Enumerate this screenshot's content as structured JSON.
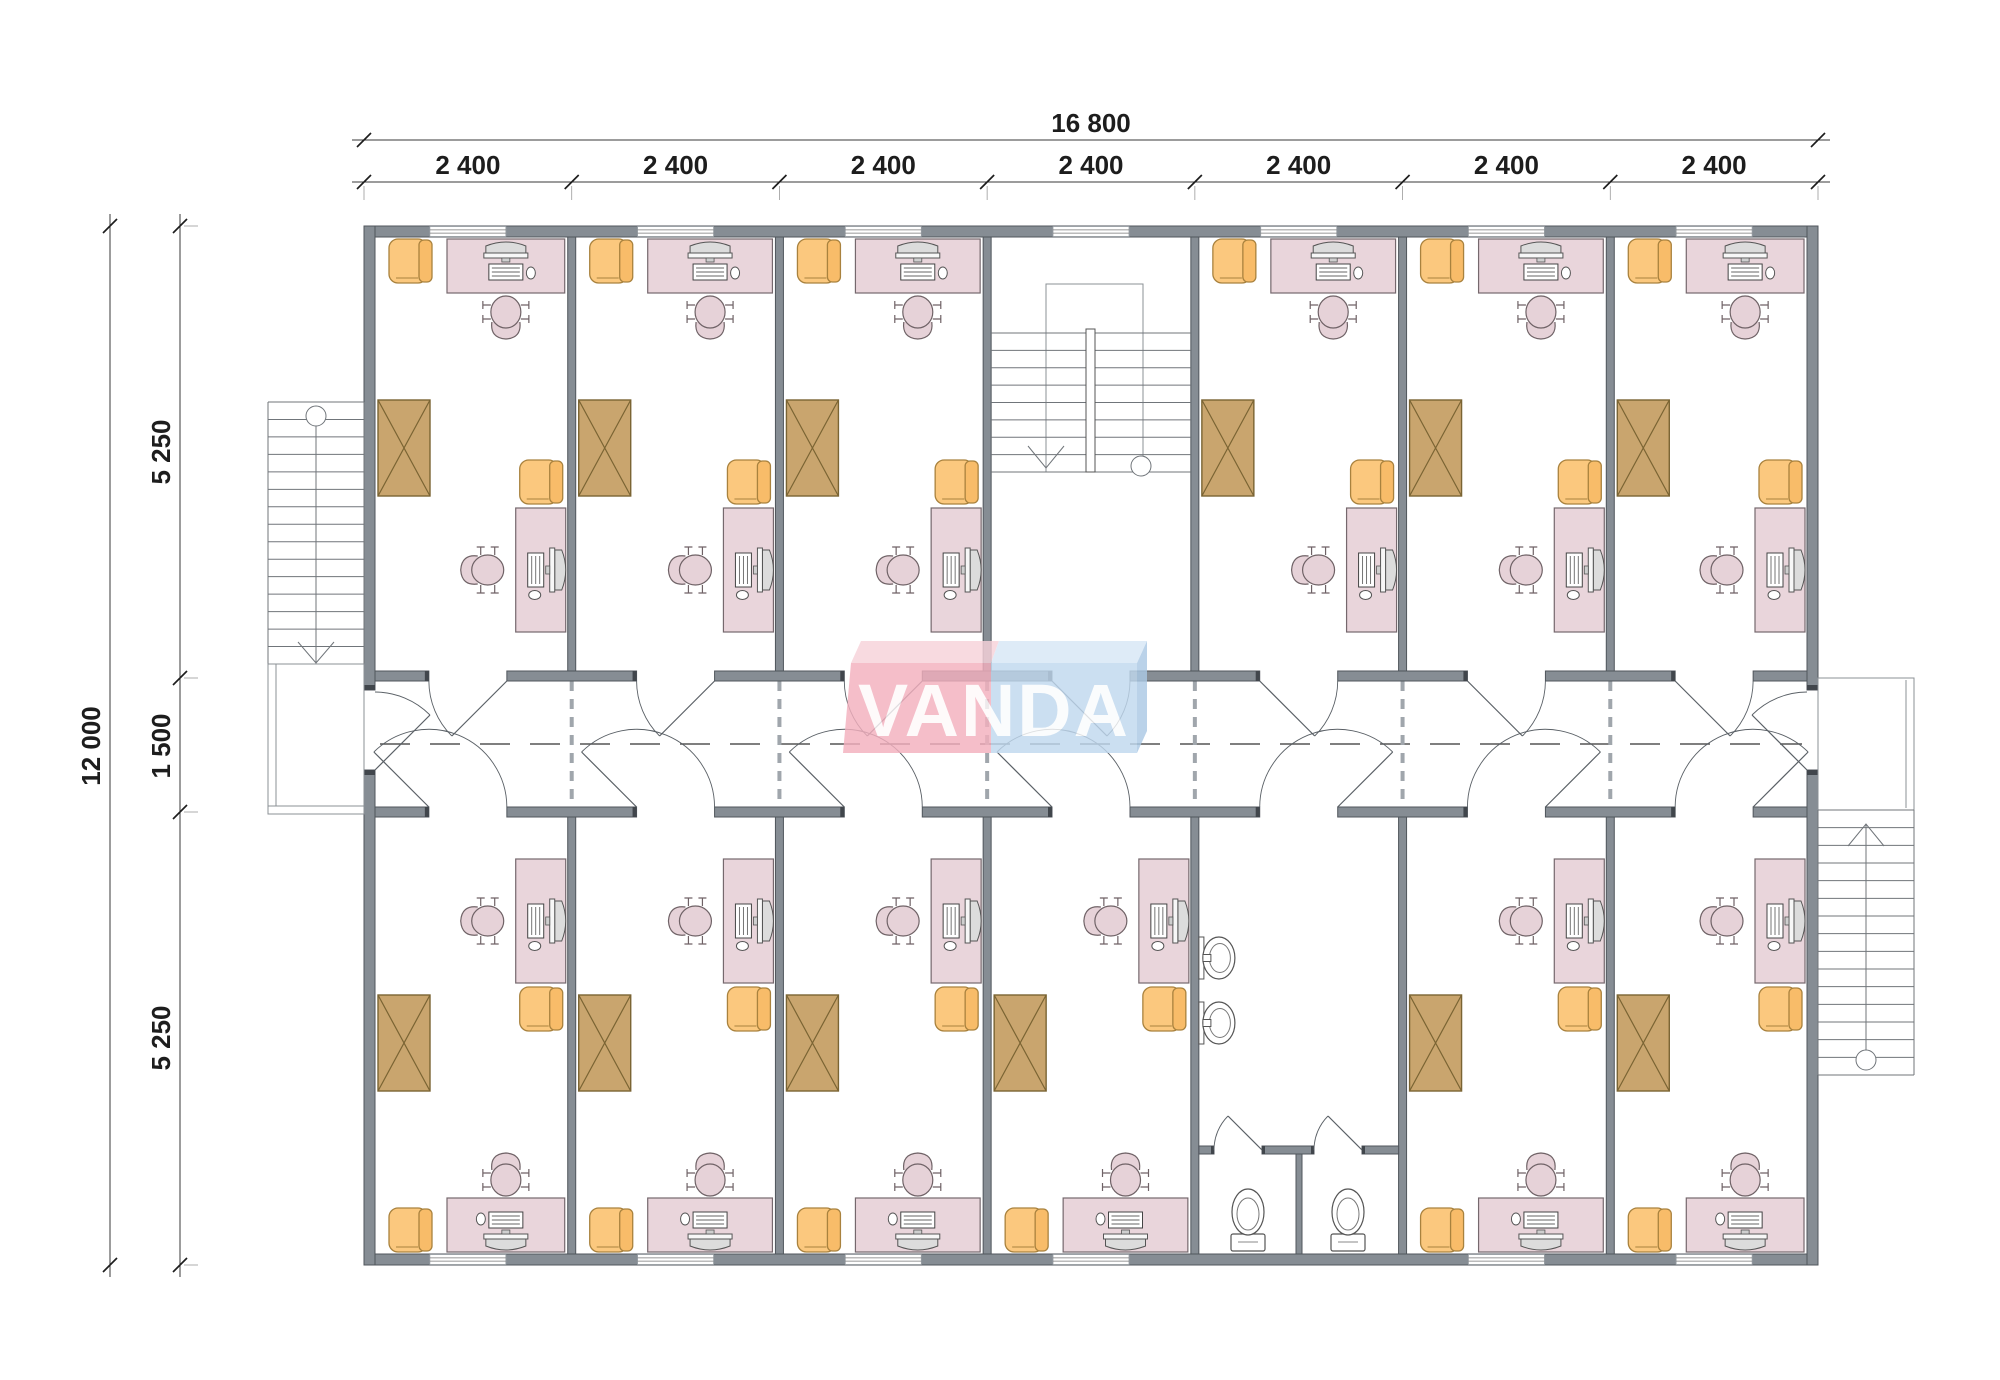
{
  "title": "VANDA modular building floor plan",
  "logo": {
    "text": "VANDA",
    "pink": "#f3b0be",
    "blue": "#c0d8ee"
  },
  "dimensions": {
    "horizontal": {
      "total": "16 800",
      "bays": [
        "2 400",
        "2 400",
        "2 400",
        "2 400",
        "2 400",
        "2 400",
        "2 400"
      ]
    },
    "vertical": {
      "total": "12 000",
      "rows": [
        "5 250",
        "1 500",
        "5 250"
      ]
    }
  },
  "colors": {
    "wall": "#868d94",
    "desk_pink": "#e9d5db",
    "chair_orange": "#fbc87e",
    "cabinet_tan": "#c9a56e",
    "dimension_text": "#1d1d1d"
  },
  "inventory": {
    "office_rooms": 12,
    "staircases": 3,
    "toilets": 2,
    "wash_basins": 2,
    "wardrobes": 12,
    "desks_with_computers": 24,
    "task_chairs": 24,
    "armchairs": 24
  },
  "icons": {
    "wardrobe": "crossed-rectangle",
    "toilet": "toilet-plan-symbol",
    "sink": "oval-basin-symbol",
    "stair": "tread-lines-with-direction-arrow",
    "door": "quarter-arc-swing",
    "computer": "monitor-with-keyboard",
    "task_chair": "swivel-chair-plan",
    "armchair": "armchair-plan",
    "window": "double-line-opening"
  }
}
